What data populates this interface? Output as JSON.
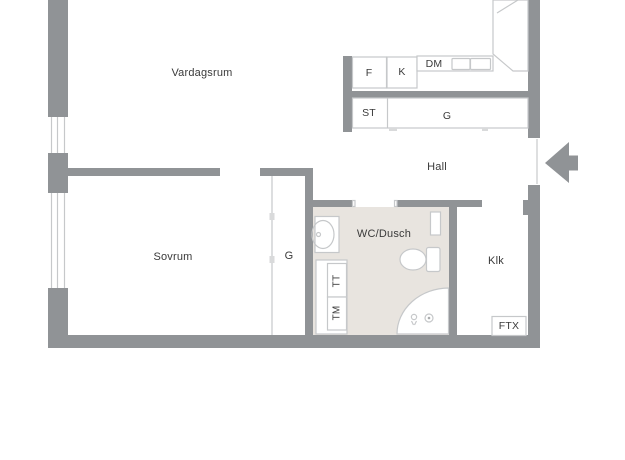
{
  "colors": {
    "wall": "#909396",
    "outline": "#c6c8ca",
    "wet_floor": "#e8e4df",
    "text": "#3a3a3a",
    "background": "#ffffff"
  },
  "rooms": {
    "living_room": {
      "label": "Vardagsrum"
    },
    "hall": {
      "label": "Hall"
    },
    "bedroom": {
      "label": "Sovrum"
    },
    "bathroom": {
      "label": "WC/Dusch"
    },
    "walk_in_closet": {
      "label": "Klk"
    }
  },
  "fixtures": {
    "freezer": "F",
    "fridge": "K",
    "dishwasher": "DM",
    "cleaning_closet": "ST",
    "hall_wardrobe": "G",
    "bedroom_wardrobe": "G",
    "tumble_dryer": "TT",
    "washing_machine": "TM",
    "ventilation_unit": "FTX"
  }
}
